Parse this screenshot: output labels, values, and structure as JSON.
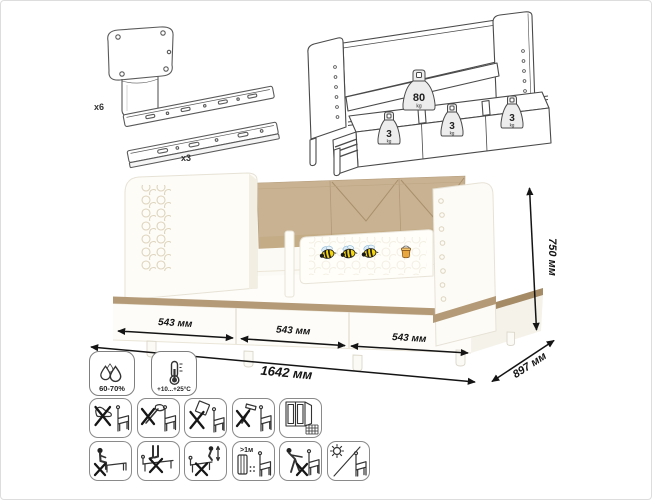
{
  "hardware": {
    "leg_label": "x6",
    "rail_label": "x3",
    "leg_name": "cylindrical-furniture-leg",
    "rail_name": "telescopic-drawer-slides"
  },
  "load": {
    "bed": {
      "value": "80",
      "unit": "kg"
    },
    "drawers": [
      {
        "value": "3",
        "unit": "kg"
      },
      {
        "value": "3",
        "unit": "kg"
      },
      {
        "value": "3",
        "unit": "kg"
      }
    ]
  },
  "dimensions": {
    "drawer1": "543 мм",
    "drawer2": "543 мм",
    "drawer3": "543 мм",
    "width": "1642 мм",
    "depth": "897 мм",
    "height": "750 мм"
  },
  "climate": {
    "humidity": "60-70%",
    "temperature": "+10...+25°C"
  },
  "care": {
    "heater_distance": ">1м",
    "row1": [
      "no-shoes-on-bed",
      "no-axe-impacts",
      "no-dropping-heavy-objects",
      "no-hammering",
      "ventilate-room"
    ],
    "row2": [
      "no-sitting-on-edge",
      "no-standing-on-bed",
      "no-jumping-on-bed",
      "keep-1m-from-heater",
      "no-dragging-furniture",
      "avoid-direct-sunlight"
    ]
  },
  "colors": {
    "cushion_beige": "#c8b292",
    "wood_trim": "#b49a77",
    "bed_white": "#fdfcf8",
    "outline_gray": "#4a4a4a",
    "dimension_black": "#141414",
    "bee_yellow": "#f6d70c"
  }
}
